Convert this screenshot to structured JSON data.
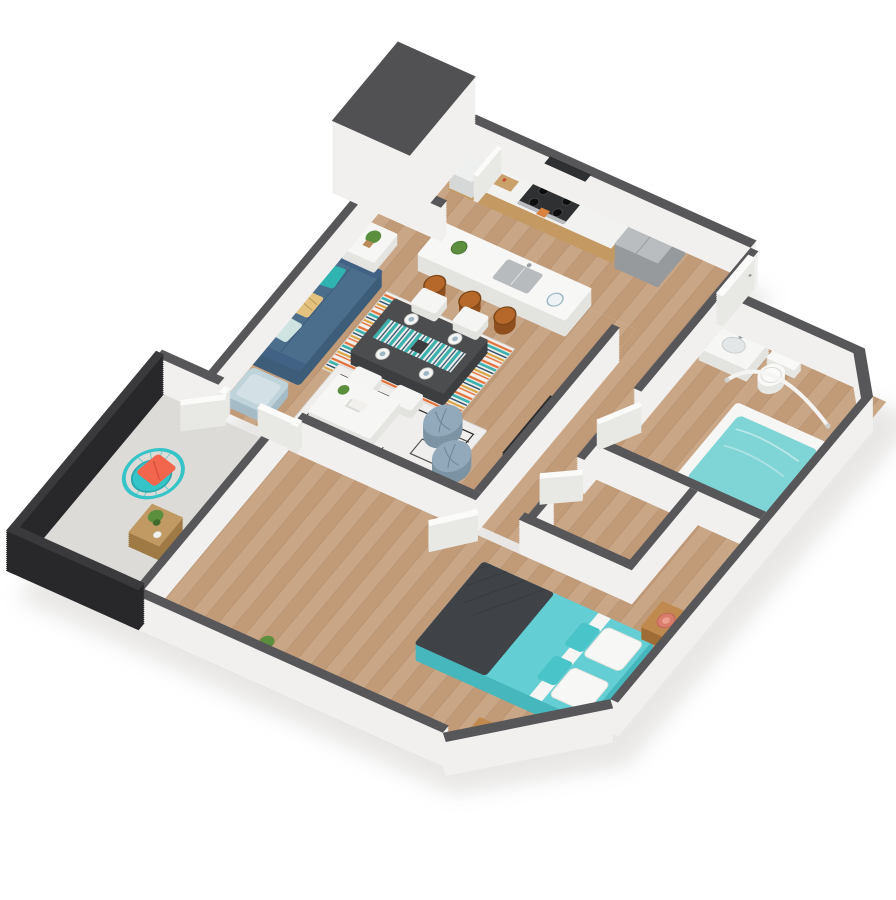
{
  "scene": {
    "kind": "3d-isometric-floor-plan-render",
    "description": "One-bedroom apartment 3D floor plan on white background, viewed isometrically",
    "rooms": [
      {
        "name": "kitchen",
        "furniture": [
          "wood-cabinets",
          "white-countertop",
          "range-with-oven",
          "microwave",
          "stainless-refrigerator",
          "cutting-board",
          "laundry-closet-with-washer"
        ]
      },
      {
        "name": "dining-area",
        "furniture": [
          "kitchen-island-with-sink",
          "three-wood-bar-stools",
          "dark-dining-table",
          "striped-table-runner",
          "four-white-chairs",
          "place-settings",
          "multicolor-striped-rug"
        ]
      },
      {
        "name": "living-room",
        "furniture": [
          "blue-sofa",
          "throw-pillows",
          "white-coffee-table",
          "two-blue-gray-poufs",
          "geometric-area-rug",
          "white-side-table",
          "light-blue-accent-chair",
          "tv-panel",
          "black-plant-stand"
        ]
      },
      {
        "name": "bedroom",
        "furniture": [
          "teal-queen-bed",
          "charcoal-throw-blanket",
          "white-pillows",
          "two-wood-nightstands",
          "two-coral-lamps",
          "dark-media-console",
          "potted-plant"
        ]
      },
      {
        "name": "bathroom",
        "furniture": [
          "vanity-with-sink",
          "toilet",
          "soaking-tub-with-water",
          "curved-shower-rod"
        ]
      },
      {
        "name": "walk-in-closet",
        "furniture": [
          "wire-shelving",
          "hanging-clothes"
        ]
      },
      {
        "name": "balcony",
        "furniture": [
          "black-slat-railing",
          "teal-wire-chair",
          "coral-pillow",
          "wood-cube-side-table",
          "succulent-plant"
        ]
      },
      {
        "name": "entry-hall",
        "furniture": [
          "front-door",
          "interior-doors"
        ]
      }
    ]
  },
  "palette": {
    "bg": "#ffffff",
    "shadow": "#b9b6b2",
    "wallFace": "#f1f0ee",
    "wallCap": "#57575a",
    "blockCap": "#515154",
    "rail": "#28282b",
    "railTop": "#3a3a3d",
    "wood1": "#c9a686",
    "wood2": "#c19a78",
    "floorSeam": "#a8815f",
    "concrete": "#dcdbd7",
    "cabWood": "#c49a62",
    "counter": "#f2f2f0",
    "applianceDark": "#2e3032",
    "steel": "#b9bdc0",
    "steelSide": "#969a9d",
    "burner": "#0c0d0d",
    "towel": "#d9823f",
    "board": "#caa06b",
    "islandTop": "#f7f7f5",
    "islandSide": "#e3e3e0",
    "sink": "#b7bbbd",
    "metal": "#9aa0a3",
    "stool": "#b5682a",
    "stoolSide": "#8f4f1e",
    "stoolEdge": "#7a4517",
    "dtableTop": "#4b4d4f",
    "dtableSide": "#3c3e40",
    "chairTop": "#f5f5f3",
    "chairSide": "#e2e2df",
    "rugBase": "#efeeec",
    "rugLine": "#2b2b2b",
    "rugTrim": "#d8d6d2",
    "rugTeal": "#3bb1ae",
    "rugOrange": "#e2703a",
    "rugNavy": "#31506b",
    "rugWhite": "#f2f0ec",
    "rugMustard": "#d9a441",
    "sofaTop": "#4b6e8c",
    "sofaSide": "#3d5d79",
    "sofaBack": "#3e5e7b",
    "sofaArm": "#426285",
    "pillowTeal": "#2fb4b1",
    "pillowSand": "#e3c27f",
    "pillowLight": "#cfe3e1",
    "pouf": "#91a9ba",
    "poufSide": "#7c93a4",
    "poufSeam": "#6d8495",
    "coffeeTop": "#f6f6f4",
    "coffeeSide": "#e4e4e1",
    "accentTop": "#bfd3da",
    "accentSide": "#a5bcc6",
    "accentCushion": "#d3e0e6",
    "tvDark": "#232426",
    "standDark": "#2f3133",
    "bedTop": "#63ced3",
    "bedSide": "#46b7bc",
    "throw": "#3f4246",
    "throwLine": "#34373a",
    "sheet": "#f5f5f3",
    "pillowWhite": "#f7f7f5",
    "bedPillowTeal": "#49c4c8",
    "nsTop": "#c08a4e",
    "nsSide": "#9e6c35",
    "lamp": "#d97d6c",
    "lampDark": "#c4685a",
    "lampIn": "#eda08f",
    "consoleTop": "#3a3c3e",
    "consoleSide": "#2e3032",
    "tubTop": "#f6f6f4",
    "tubSide": "#e3e3e0",
    "water": "#7fd4d6",
    "toiletTop": "#f9f9f7",
    "toiletSide": "#e6e6e3",
    "doorWhite": "#fbfbfa",
    "doorSide": "#e8e8e5",
    "doorEdge": "#d8d8d5",
    "knob": "#9a9a98",
    "cube": "#c19a63",
    "cubeSide": "#9f7a44",
    "balcChair": "#35c4c8",
    "balcChairDark": "#2aa9ad",
    "pillowCoral": "#f2664e",
    "coralFold": "#d94f3c",
    "plantGreen": "#5b8f3d",
    "plantDark": "#3f6b2c",
    "pot": "#b98a5a",
    "dish": "#f2f2f0",
    "shelf": "#e8eaea",
    "clothesA": "#7fb2c9",
    "clothesB": "#5a8da6",
    "washer": "#eef0f0",
    "washerSide": "#d6d8d8",
    "books": "#7fb2c9",
    "paper": "#f4f4f2",
    "plateRing": "#9db7c4",
    "plateIn": "#eef2f4"
  }
}
